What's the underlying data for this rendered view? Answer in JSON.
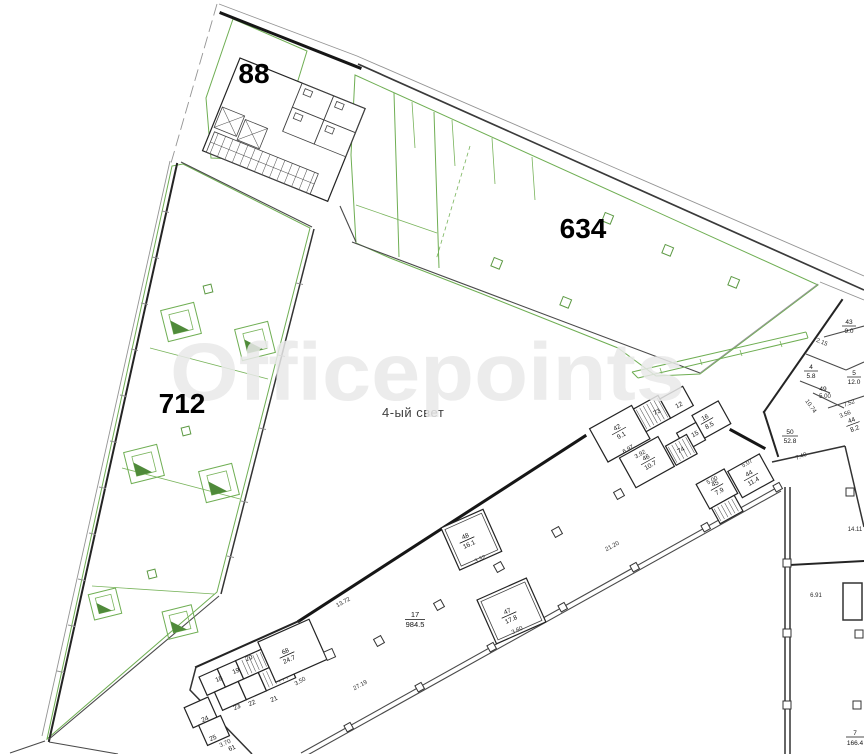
{
  "watermark_text": "Officepoints",
  "atrium_label": "4-ый свет",
  "areas": {
    "a88": "88",
    "a634": "634",
    "a712": "712"
  },
  "colors": {
    "highlight": "#b9e09b",
    "green_line": "#6fae53",
    "green_dark": "#4f8a3a",
    "wall": "#161616",
    "watermark": "#e9e9e9"
  },
  "rooms": {
    "r17": {
      "num": "17",
      "area": "984.5"
    },
    "r68": {
      "num": "68",
      "area": "24.7"
    },
    "r42": {
      "num": "42",
      "area": "9.1"
    },
    "r46": {
      "num": "46",
      "area": "10.7"
    },
    "r16": {
      "num": "16",
      "area": "8.5"
    },
    "r45": {
      "num": "45",
      "area": "7.9"
    },
    "r44": {
      "num": "44",
      "area": "11.4"
    },
    "r48": {
      "num": "48",
      "area": "16.1"
    },
    "r47": {
      "num": "47",
      "area": "17.8"
    },
    "r43": {
      "num": "43",
      "area": "9.0"
    },
    "r4": {
      "num": "4",
      "area": "5.8"
    },
    "r5": {
      "num": "5",
      "area": "12.0"
    },
    "r44b": {
      "num": "44",
      "area": "8.2"
    },
    "r50": {
      "num": "50",
      "area": "52.8"
    },
    "r7": {
      "num": "7",
      "area": "166.4"
    },
    "r12": "12",
    "r15": "15",
    "r73": "73",
    "r74": "74",
    "r49": "49",
    "r18": "18",
    "r19": "19",
    "r20": "20",
    "r21": "21",
    "r22": "22",
    "r23": "23",
    "r24": "24",
    "r25": "25",
    "r61": "61"
  },
  "dims": {
    "d2120": "21.20",
    "d2719": "27.19",
    "d1372": "13.72",
    "d392": "3.92",
    "d697": "6.97",
    "d350": "3.50",
    "d370": "3.70",
    "d332": "3.32",
    "d360": "3.60",
    "d507": "5.07",
    "d500": "5.00",
    "d215": "2.15",
    "d1074": "10.74",
    "d752": "7.52",
    "d356": "3.56",
    "d740": "7.40",
    "d1411": "14.11",
    "d691": "6.91"
  }
}
